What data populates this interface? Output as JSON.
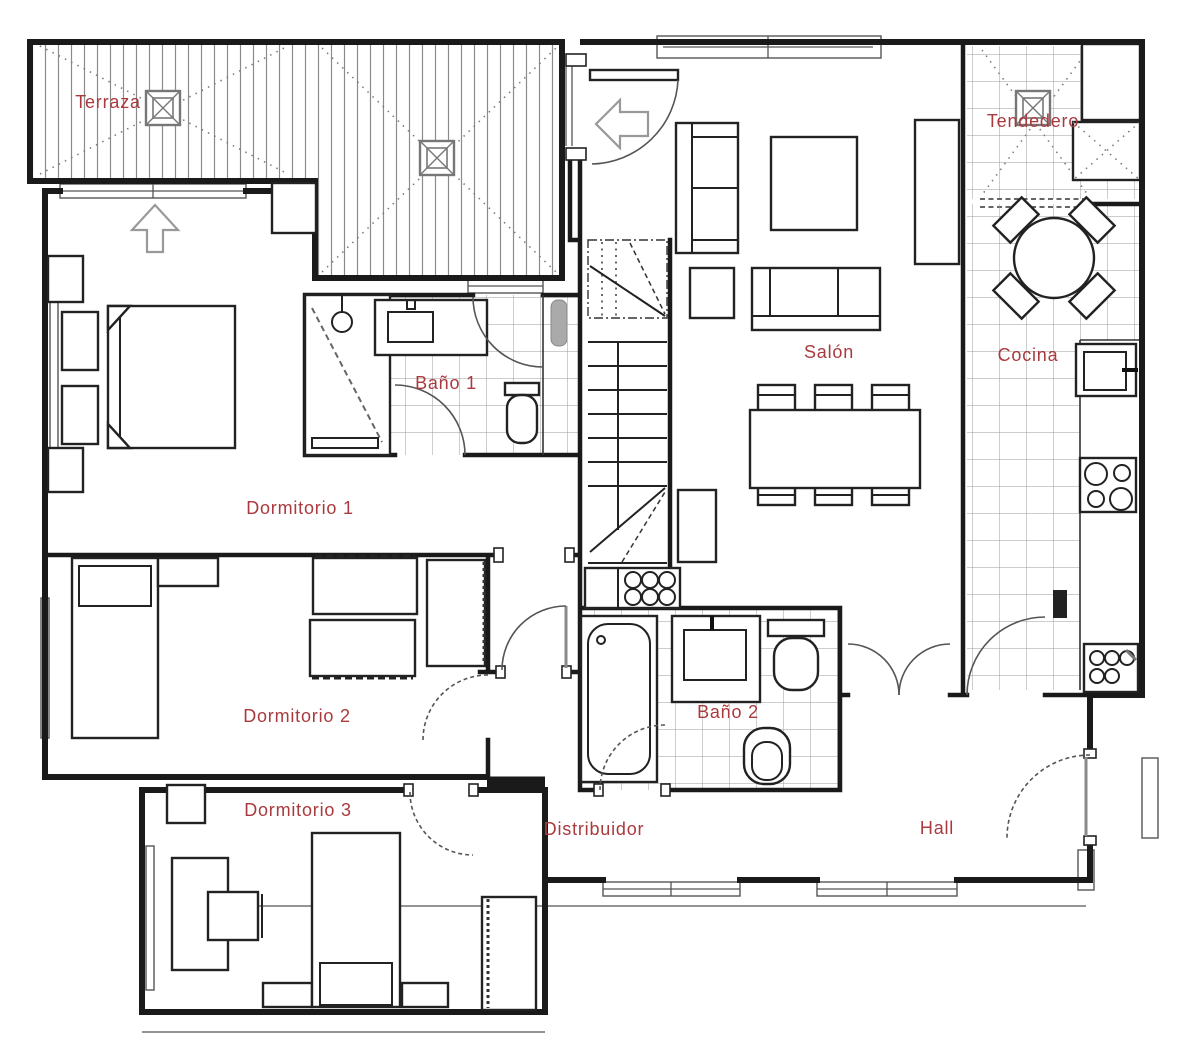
{
  "rooms": {
    "terraza": {
      "label": "Terraza"
    },
    "tendedero": {
      "label": "Tendedero"
    },
    "salon": {
      "label": "Salón"
    },
    "cocina": {
      "label": "Cocina"
    },
    "bano1": {
      "label": "Baño 1"
    },
    "dormitorio1": {
      "label": "Dormitorio 1"
    },
    "dormitorio2": {
      "label": "Dormitorio 2"
    },
    "dormitorio3": {
      "label": "Dormitorio 3"
    },
    "bano2": {
      "label": "Baño 2"
    },
    "distribuidor": {
      "label": "Distribuidor"
    },
    "hall": {
      "label": "Hall"
    }
  },
  "colors": {
    "label": "#a93a3e",
    "walls": "#1a1a1a",
    "grid": "#9b9b9b",
    "deck_stripe": "#8b8b8b",
    "background": "#ffffff"
  },
  "icons": {
    "drain": "crossed-square",
    "exit_terrace": "arrow-up",
    "exit_salon": "arrow-left"
  }
}
